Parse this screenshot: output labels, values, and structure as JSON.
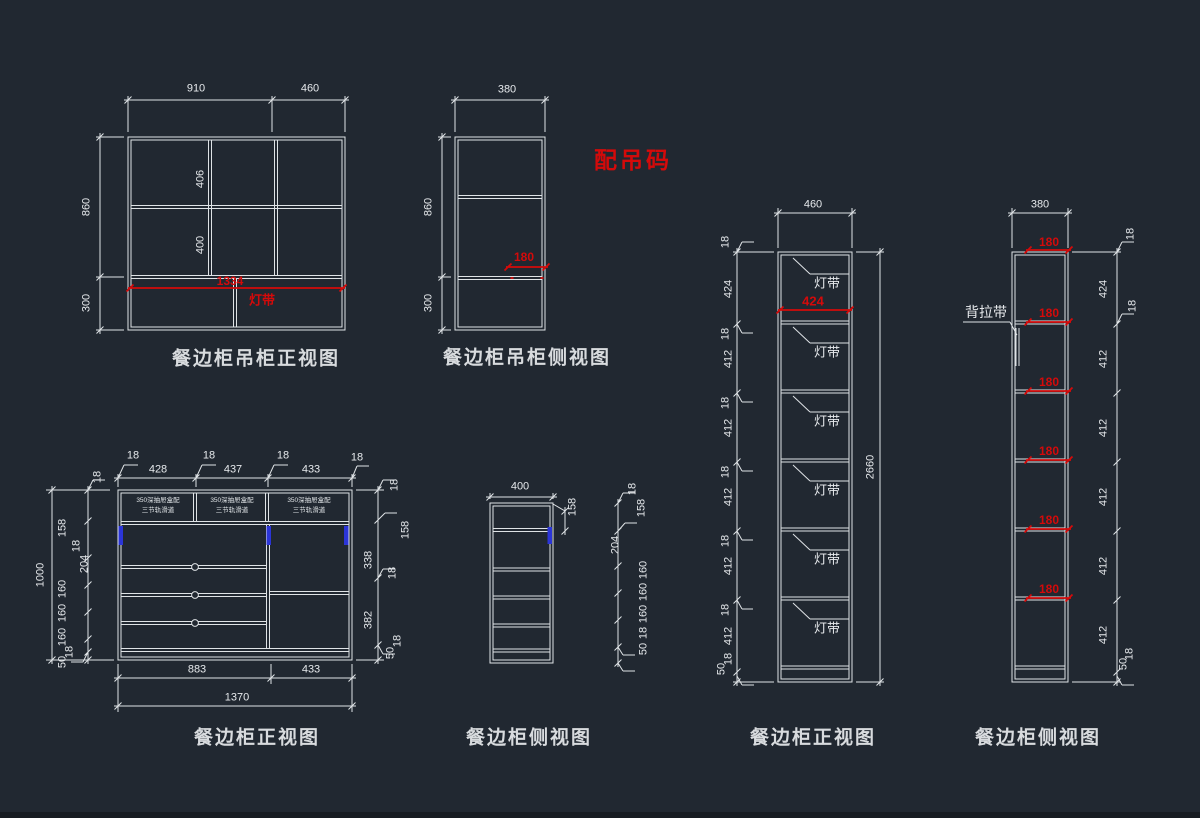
{
  "drawing": {
    "kind": "CAD cabinet drawing",
    "background": "#212831",
    "line_color": "#dfe3e6",
    "red": "#d40a0a",
    "blue": "#2b35d8"
  },
  "annotations": {
    "hanging_hardware_note": "配吊码",
    "back_strap_label": "背拉带",
    "light_strip_label": "灯带"
  },
  "views": [
    {
      "key": "hanging_cabinet_front",
      "title": "餐边柜吊柜正视图",
      "dim_labels": [
        {
          "t": "910",
          "x": 196,
          "y": 89
        },
        {
          "t": "460",
          "x": 310,
          "y": 89
        },
        {
          "t": "860",
          "x": 87,
          "y": 207,
          "r": 1
        },
        {
          "t": "300",
          "x": 87,
          "y": 303,
          "r": 1
        },
        {
          "t": "406",
          "x": 201,
          "y": 179,
          "r": 1
        },
        {
          "t": "400",
          "x": 201,
          "y": 245,
          "r": 1
        },
        {
          "t": "1334",
          "x": 230,
          "y": 281,
          "c": "red"
        },
        {
          "t": "灯带",
          "x": 262,
          "y": 300,
          "c": "redmid"
        }
      ]
    },
    {
      "key": "hanging_cabinet_side",
      "title": "餐边柜吊柜侧视图",
      "dim_labels": [
        {
          "t": "380",
          "x": 507,
          "y": 90
        },
        {
          "t": "860",
          "x": 429,
          "y": 207,
          "r": 1
        },
        {
          "t": "300",
          "x": 429,
          "y": 303,
          "r": 1
        },
        {
          "t": "180",
          "x": 524,
          "y": 257,
          "c": "red"
        }
      ]
    },
    {
      "key": "cabinet_front",
      "title": "餐边柜正视图",
      "dim_labels": [
        {
          "t": "18",
          "x": 133,
          "y": 456
        },
        {
          "t": "428",
          "x": 158,
          "y": 470
        },
        {
          "t": "18",
          "x": 209,
          "y": 456
        },
        {
          "t": "437",
          "x": 233,
          "y": 470
        },
        {
          "t": "18",
          "x": 283,
          "y": 456
        },
        {
          "t": "433",
          "x": 311,
          "y": 470
        },
        {
          "t": "18",
          "x": 357,
          "y": 458
        },
        {
          "t": "350深抽屉盒配",
          "x": 158,
          "y": 501,
          "c": "tiny"
        },
        {
          "t": "三节轨滑道",
          "x": 158,
          "y": 511,
          "c": "tiny"
        },
        {
          "t": "350深抽屉盒配",
          "x": 232,
          "y": 501,
          "c": "tiny"
        },
        {
          "t": "三节轨滑道",
          "x": 232,
          "y": 511,
          "c": "tiny"
        },
        {
          "t": "350深抽屉盒配",
          "x": 309,
          "y": 501,
          "c": "tiny"
        },
        {
          "t": "三节轨滑道",
          "x": 309,
          "y": 511,
          "c": "tiny"
        },
        {
          "t": "883",
          "x": 197,
          "y": 670
        },
        {
          "t": "433",
          "x": 311,
          "y": 670
        },
        {
          "t": "1370",
          "x": 237,
          "y": 698
        },
        {
          "t": "1000",
          "x": 41,
          "y": 575,
          "r": 1
        },
        {
          "t": "18",
          "x": 98,
          "y": 477,
          "r": 1
        },
        {
          "t": "158",
          "x": 63,
          "y": 528,
          "r": 1
        },
        {
          "t": "18",
          "x": 77,
          "y": 546,
          "r": 1
        },
        {
          "t": "204",
          "x": 85,
          "y": 564,
          "r": 1
        },
        {
          "t": "160",
          "x": 63,
          "y": 589,
          "r": 1
        },
        {
          "t": "160",
          "x": 63,
          "y": 613,
          "r": 1
        },
        {
          "t": "160",
          "x": 63,
          "y": 637,
          "r": 1
        },
        {
          "t": "18",
          "x": 70,
          "y": 652,
          "r": 1
        },
        {
          "t": "50",
          "x": 63,
          "y": 662,
          "r": 1
        },
        {
          "t": "18",
          "x": 395,
          "y": 485,
          "r": 1
        },
        {
          "t": "158",
          "x": 406,
          "y": 530,
          "r": 1
        },
        {
          "t": "338",
          "x": 369,
          "y": 560,
          "r": 1
        },
        {
          "t": "18",
          "x": 393,
          "y": 573,
          "r": 1
        },
        {
          "t": "382",
          "x": 369,
          "y": 620,
          "r": 1
        },
        {
          "t": "18",
          "x": 398,
          "y": 641,
          "r": 1
        },
        {
          "t": "50",
          "x": 391,
          "y": 653,
          "r": 1
        }
      ]
    },
    {
      "key": "cabinet_side",
      "title": "餐边柜侧视图",
      "dim_labels": [
        {
          "t": "400",
          "x": 520,
          "y": 487
        },
        {
          "t": "158",
          "x": 573,
          "y": 507,
          "r": 1
        },
        {
          "t": "18",
          "x": 633,
          "y": 489,
          "r": 1
        },
        {
          "t": "158",
          "x": 642,
          "y": 508,
          "r": 1
        },
        {
          "t": "204",
          "x": 616,
          "y": 545,
          "r": 1
        },
        {
          "t": "160",
          "x": 644,
          "y": 570,
          "r": 1
        },
        {
          "t": "160",
          "x": 644,
          "y": 592,
          "r": 1
        },
        {
          "t": "160",
          "x": 644,
          "y": 614,
          "r": 1
        },
        {
          "t": "18",
          "x": 644,
          "y": 633,
          "r": 1
        },
        {
          "t": "50",
          "x": 644,
          "y": 649,
          "r": 1
        }
      ]
    },
    {
      "key": "tall_cabinet_front",
      "title": "餐边柜正视图",
      "dim_labels": [
        {
          "t": "460",
          "x": 813,
          "y": 205
        },
        {
          "t": "2660",
          "x": 871,
          "y": 467,
          "r": 1
        },
        {
          "t": "424",
          "x": 813,
          "y": 301,
          "c": "redmid"
        },
        {
          "t": "灯带",
          "x": 827,
          "y": 283,
          "c": "mid"
        },
        {
          "t": "灯带",
          "x": 827,
          "y": 352,
          "c": "mid"
        },
        {
          "t": "灯带",
          "x": 827,
          "y": 421,
          "c": "mid"
        },
        {
          "t": "灯带",
          "x": 827,
          "y": 490,
          "c": "mid"
        },
        {
          "t": "灯带",
          "x": 827,
          "y": 559,
          "c": "mid"
        },
        {
          "t": "灯带",
          "x": 827,
          "y": 628,
          "c": "mid"
        },
        {
          "t": "18",
          "x": 726,
          "y": 242,
          "r": 1
        },
        {
          "t": "424",
          "x": 729,
          "y": 289,
          "r": 1
        },
        {
          "t": "18",
          "x": 726,
          "y": 334,
          "r": 1
        },
        {
          "t": "412",
          "x": 729,
          "y": 359,
          "r": 1
        },
        {
          "t": "18",
          "x": 726,
          "y": 403,
          "r": 1
        },
        {
          "t": "412",
          "x": 729,
          "y": 428,
          "r": 1
        },
        {
          "t": "18",
          "x": 726,
          "y": 472,
          "r": 1
        },
        {
          "t": "412",
          "x": 729,
          "y": 497,
          "r": 1
        },
        {
          "t": "18",
          "x": 726,
          "y": 541,
          "r": 1
        },
        {
          "t": "412",
          "x": 729,
          "y": 566,
          "r": 1
        },
        {
          "t": "18",
          "x": 726,
          "y": 610,
          "r": 1
        },
        {
          "t": "412",
          "x": 729,
          "y": 636,
          "r": 1
        },
        {
          "t": "18",
          "x": 729,
          "y": 659,
          "r": 1
        },
        {
          "t": "50",
          "x": 722,
          "y": 669,
          "r": 1
        }
      ]
    },
    {
      "key": "tall_cabinet_side",
      "title": "餐边柜侧视图",
      "dim_labels": [
        {
          "t": "380",
          "x": 1040,
          "y": 205
        },
        {
          "t": "180",
          "x": 1049,
          "y": 242,
          "c": "red"
        },
        {
          "t": "180",
          "x": 1049,
          "y": 313,
          "c": "red"
        },
        {
          "t": "180",
          "x": 1049,
          "y": 382,
          "c": "red"
        },
        {
          "t": "180",
          "x": 1049,
          "y": 451,
          "c": "red"
        },
        {
          "t": "180",
          "x": 1049,
          "y": 520,
          "c": "red"
        },
        {
          "t": "180",
          "x": 1049,
          "y": 589,
          "c": "red"
        },
        {
          "t": "18",
          "x": 1131,
          "y": 234,
          "r": 1
        },
        {
          "t": "424",
          "x": 1104,
          "y": 289,
          "r": 1
        },
        {
          "t": "18",
          "x": 1133,
          "y": 306,
          "r": 1
        },
        {
          "t": "412",
          "x": 1104,
          "y": 359,
          "r": 1
        },
        {
          "t": "412",
          "x": 1104,
          "y": 428,
          "r": 1
        },
        {
          "t": "412",
          "x": 1104,
          "y": 497,
          "r": 1
        },
        {
          "t": "412",
          "x": 1104,
          "y": 566,
          "r": 1
        },
        {
          "t": "412",
          "x": 1104,
          "y": 635,
          "r": 1
        },
        {
          "t": "18",
          "x": 1130,
          "y": 654,
          "r": 1
        },
        {
          "t": "50",
          "x": 1124,
          "y": 664,
          "r": 1
        }
      ]
    }
  ]
}
